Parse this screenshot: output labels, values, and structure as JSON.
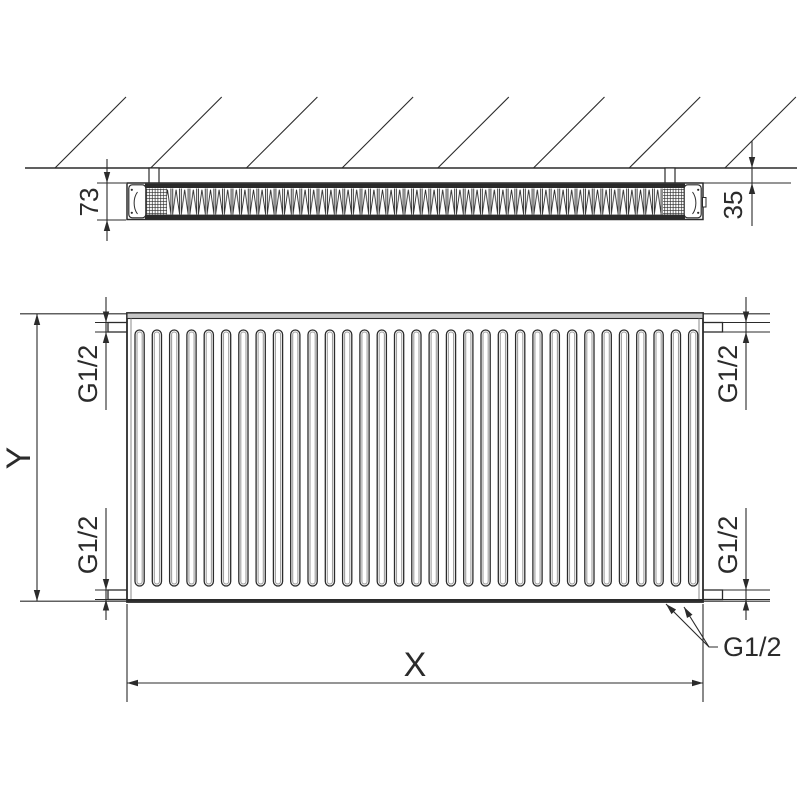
{
  "top_view": {
    "depth_mm": "73",
    "wall_distance_mm": "35"
  },
  "front_view": {
    "height_label": "Y",
    "width_label": "X",
    "connections": {
      "top_left": "G1/2",
      "bottom_left": "G1/2",
      "top_right": "G1/2",
      "bottom_right": "G1/2",
      "callout": "G1/2"
    }
  },
  "geometry": {
    "front_fins": 33,
    "hatch_lines": 8
  },
  "colors": {
    "line": "#2b2b2b",
    "rail_fill": "#c6c6c6",
    "fin_inner": "#a0a0a0",
    "background": "#ffffff"
  }
}
